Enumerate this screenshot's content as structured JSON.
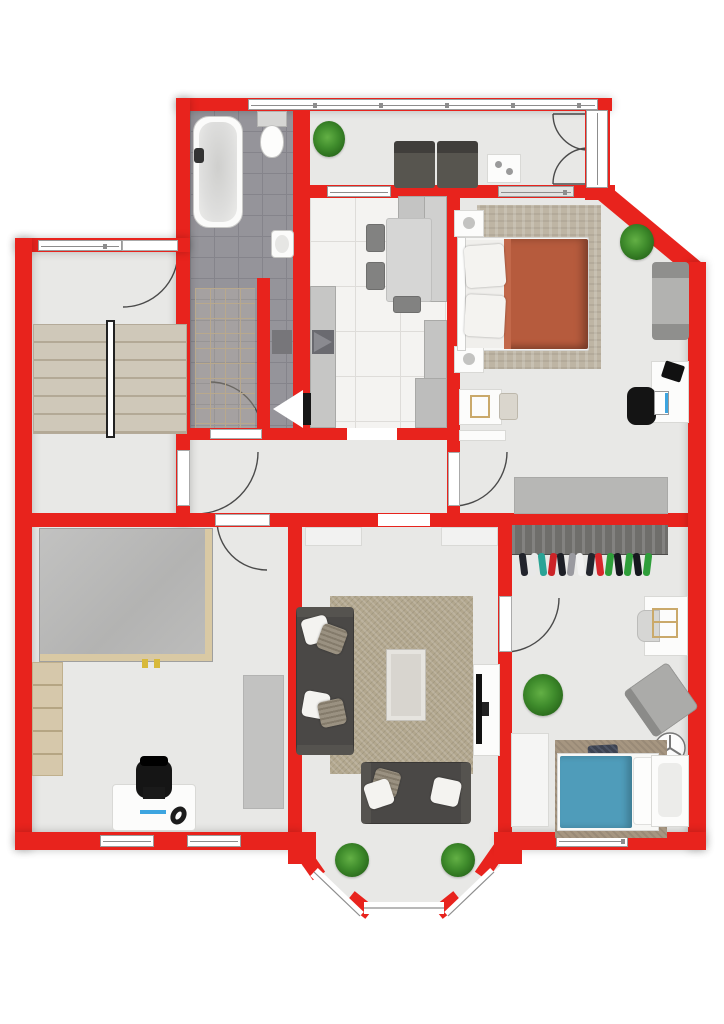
{
  "app": {
    "type": "floor-plan",
    "description": "Top-down 2D apartment floor plan with red walls"
  },
  "colors": {
    "wall": "#e8231d",
    "floor": "#e8e8e6",
    "bath_tile": "#95949a",
    "bath_grout": "#85848b",
    "kitchen_tile": "#f4f3f1",
    "kitchen_grout": "#dedcd9",
    "stair_tread": "#cfc8b9",
    "stair_edge": "#b3a996",
    "rug_bedroom": "#beb5a4",
    "rug_living": "#b2a78e",
    "rug_kids": "#a69681",
    "sofa": "#4a4846",
    "blanket_master": "#b65b3d",
    "blanket_kids": "#4f9cba",
    "wood_trim": "#d9c9a4",
    "wardrobe_wood": "#6f6e6b",
    "plant": "#3f8c2c",
    "plant_dark": "#2a6b1c",
    "furniture_gray": "#bcbcbb",
    "furniture_white": "#fcfcfb",
    "window_frame": "#9b9b9b",
    "door_line": "#4a4a4a",
    "shelf_beige": "#d6c8ab",
    "accent_blue": "#3da5e0",
    "accent_yellow": "#d8b93a"
  },
  "rooms": [
    {
      "id": "stairwell",
      "features": [
        "double-flight-stairs",
        "entry-door",
        "windows"
      ]
    },
    {
      "id": "bathroom",
      "features": [
        "bathtub",
        "toilet",
        "sink",
        "dark-tile-floor"
      ]
    },
    {
      "id": "sunroom",
      "features": [
        "two-armchairs",
        "side-table",
        "plant",
        "french-door",
        "window-band"
      ]
    },
    {
      "id": "kitchen",
      "features": [
        "dining-table",
        "chairs",
        "counters",
        "stove"
      ]
    },
    {
      "id": "master-bedroom",
      "features": [
        "double-bed",
        "nightstands",
        "rug",
        "lounge-chair",
        "desk",
        "office-chair",
        "plant",
        "sideboard"
      ]
    },
    {
      "id": "corridor",
      "features": [
        "doors-to-all-rooms"
      ]
    },
    {
      "id": "office-room",
      "features": [
        "large-table",
        "shelf",
        "desk",
        "office-chair",
        "headset",
        "rug"
      ]
    },
    {
      "id": "living-room",
      "features": [
        "corner-sofa",
        "second-sofa",
        "coffee-table",
        "tv-stand",
        "tv",
        "rug",
        "bay-window",
        "plants"
      ]
    },
    {
      "id": "kids-room",
      "features": [
        "open-wardrobe",
        "clothes",
        "desk",
        "chair",
        "armchair",
        "plant",
        "single-bed",
        "loveseat",
        "ceiling-fan",
        "rug",
        "cabinet"
      ]
    }
  ],
  "kids_room": {
    "clothes_colors": [
      "#22242c",
      "#e8e8e8",
      "#2aa396",
      "#cc2428",
      "#1d1f26",
      "#9a9aa0",
      "#f0f0f0",
      "#23262e",
      "#d8262b",
      "#2f9e3a",
      "#16181e",
      "#2f9e3a",
      "#16181e",
      "#2f9e3a"
    ]
  }
}
